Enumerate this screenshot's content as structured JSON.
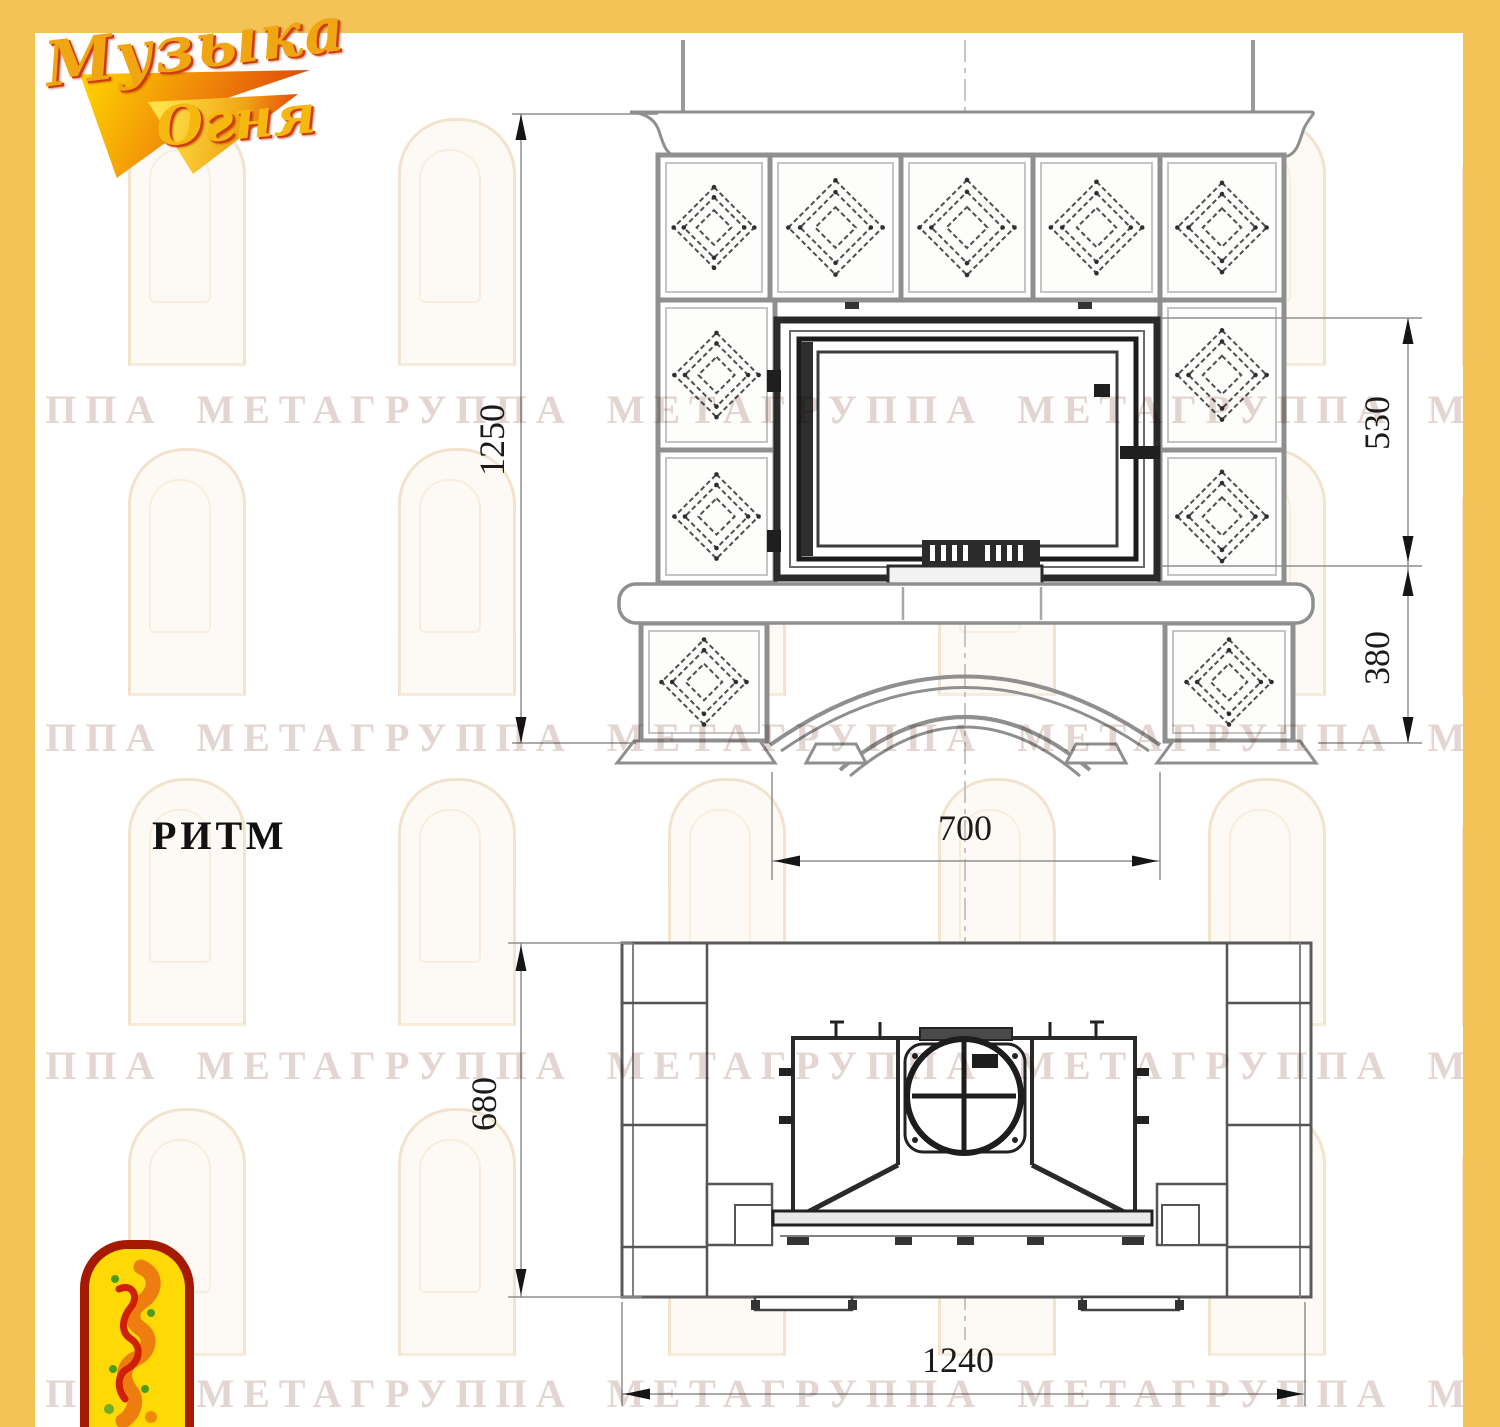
{
  "brand": {
    "line1": "Музыка",
    "line2": "Огня"
  },
  "page": {
    "model_name": "РИТМ"
  },
  "watermark": {
    "text": "ГРУППА МЕТАГРУППА МЕТАГРУППА МЕТАГРУППА МЕТА"
  },
  "views": {
    "front": {
      "label": "front elevation of tiled fireplace",
      "dimensions": {
        "overall_height_mm": "1250",
        "firebox_zone_height_mm": "530",
        "base_zone_height_mm": "380",
        "firebox_width_mm": "700"
      }
    },
    "plan": {
      "label": "top plan view of tiled fireplace",
      "dimensions": {
        "depth_mm": "680",
        "overall_width_mm": "1240"
      }
    }
  },
  "colors": {
    "frame_yellow": "#f3c355",
    "emblem_red": "#a51a00",
    "emblem_yellow": "#ffd905",
    "line_gray": "#8f8f8f",
    "dark_line": "#232323"
  }
}
